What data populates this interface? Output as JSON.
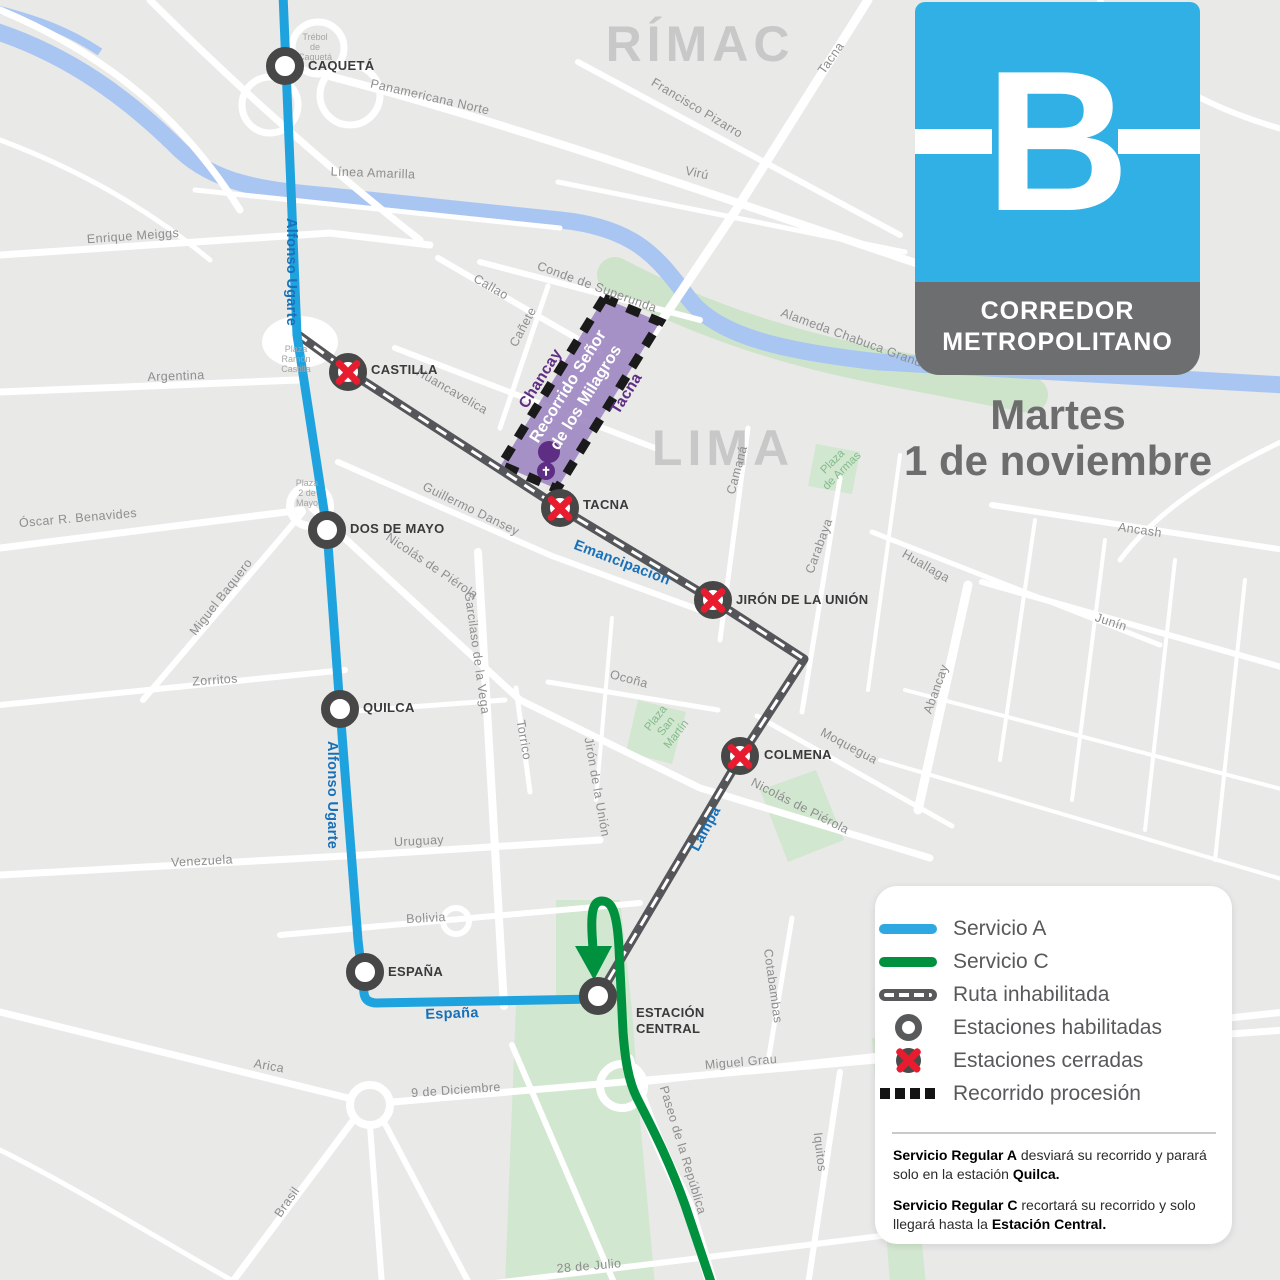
{
  "header": {
    "logo_letter": "B",
    "title_line1": "CORREDOR",
    "title_line2": "METROPOLITANO",
    "date_line1": "Martes",
    "date_line2": "1 de noviembre"
  },
  "legend": {
    "items": [
      {
        "icon": "line-blue",
        "label": "Servicio A"
      },
      {
        "icon": "line-green",
        "label": "Servicio C"
      },
      {
        "icon": "line-disabled",
        "label": "Ruta inhabilitada"
      },
      {
        "icon": "station-open",
        "label": "Estaciones habilitadas"
      },
      {
        "icon": "station-closed",
        "label": "Estaciones cerradas"
      },
      {
        "icon": "procession",
        "label": "Recorrido procesión"
      }
    ]
  },
  "notes": [
    {
      "segments": [
        {
          "text": "Servicio Regular A",
          "bold": true
        },
        {
          "text": " desviará su recorrido y parará solo en la estación ",
          "bold": false
        },
        {
          "text": "Quilca.",
          "bold": true
        }
      ]
    },
    {
      "segments": [
        {
          "text": "Servicio Regular C",
          "bold": true
        },
        {
          "text": " recortará su recorrido y solo llegará hasta la ",
          "bold": false
        },
        {
          "text": "Estación Central.",
          "bold": true
        }
      ]
    }
  ],
  "colors": {
    "servicio_a_blue": "#1FA3DF",
    "servicio_c_green": "#00913F",
    "ruta_inhabilitada_gray": "#54565A",
    "procession_purple": "#9D87C1",
    "purple_dark": "#5E2D84",
    "closed_red": "#E81C2E",
    "logo_blue": "#30B0E5",
    "logo_gray": "#6D6E70"
  },
  "map": {
    "procession_label": "Recorrido Señor\nde los Milagros",
    "church_glyph": "✝",
    "labels": [
      {
        "t": "RÍMAC",
        "x": 700,
        "y": 44,
        "r": 0,
        "s": "district"
      },
      {
        "t": "LIMA",
        "x": 723,
        "y": 448,
        "r": 0,
        "s": "district"
      },
      {
        "t": "Trébol\nde\nCaquetá",
        "x": 315,
        "y": 47,
        "r": 0,
        "s": "tiny"
      },
      {
        "t": "Panamericana Norte",
        "x": 430,
        "y": 97,
        "r": 13,
        "s": "st"
      },
      {
        "t": "Línea Amarilla",
        "x": 373,
        "y": 173,
        "r": 2,
        "s": "st"
      },
      {
        "t": "Enrique Meiggs",
        "x": 133,
        "y": 236,
        "r": -4,
        "s": "st"
      },
      {
        "t": "Alfonso Ugarte",
        "x": 291,
        "y": 272,
        "r": 90,
        "s": "blue"
      },
      {
        "t": "Alfonso Ugarte",
        "x": 332,
        "y": 795,
        "r": 90,
        "s": "blue"
      },
      {
        "t": "Argentina",
        "x": 176,
        "y": 376,
        "r": -2,
        "s": "st"
      },
      {
        "t": "Óscar R. Benavides",
        "x": 78,
        "y": 518,
        "r": -5,
        "s": "st"
      },
      {
        "t": "Miguel Baquero",
        "x": 221,
        "y": 597,
        "r": -52,
        "s": "st"
      },
      {
        "t": "Zorritos",
        "x": 215,
        "y": 680,
        "r": -4,
        "s": "st"
      },
      {
        "t": "Venezuela",
        "x": 202,
        "y": 861,
        "r": -3,
        "s": "st"
      },
      {
        "t": "Uruguay",
        "x": 419,
        "y": 841,
        "r": -3,
        "s": "st"
      },
      {
        "t": "Bolivia",
        "x": 426,
        "y": 918,
        "r": -3,
        "s": "st"
      },
      {
        "t": "España",
        "x": 452,
        "y": 1014,
        "r": -2,
        "s": "blue"
      },
      {
        "t": "Arica",
        "x": 269,
        "y": 1066,
        "r": 10,
        "s": "st"
      },
      {
        "t": "Brasil",
        "x": 287,
        "y": 1202,
        "r": -55,
        "s": "st"
      },
      {
        "t": "9 de Diciembre",
        "x": 456,
        "y": 1090,
        "r": -4,
        "s": "st"
      },
      {
        "t": "28 de Julio",
        "x": 589,
        "y": 1266,
        "r": -5,
        "s": "st"
      },
      {
        "t": "Miguel Grau",
        "x": 741,
        "y": 1062,
        "r": -5,
        "s": "st"
      },
      {
        "t": "Iquitos",
        "x": 820,
        "y": 1152,
        "r": 83,
        "s": "st"
      },
      {
        "t": "Cotabambas",
        "x": 773,
        "y": 986,
        "r": 82,
        "s": "st"
      },
      {
        "t": "Paseo de la República",
        "x": 683,
        "y": 1150,
        "r": 73,
        "s": "st"
      },
      {
        "t": "Lampa",
        "x": 706,
        "y": 829,
        "r": -62,
        "s": "blue"
      },
      {
        "t": "Nicolás de Piérola",
        "x": 800,
        "y": 806,
        "r": 27,
        "s": "st"
      },
      {
        "t": "Moquegua",
        "x": 849,
        "y": 746,
        "r": 28,
        "s": "st"
      },
      {
        "t": "Emancipación",
        "x": 622,
        "y": 563,
        "r": 21,
        "s": "blue"
      },
      {
        "t": "Ocoña",
        "x": 629,
        "y": 679,
        "r": 15,
        "s": "st"
      },
      {
        "t": "Jirón de la Unión",
        "x": 597,
        "y": 787,
        "r": 80,
        "s": "st"
      },
      {
        "t": "Torrico",
        "x": 524,
        "y": 740,
        "r": 80,
        "s": "st"
      },
      {
        "t": "Garcilaso de la Vega",
        "x": 477,
        "y": 653,
        "r": 82,
        "s": "st"
      },
      {
        "t": "Nicolás de Piérola",
        "x": 432,
        "y": 566,
        "r": 34,
        "s": "st"
      },
      {
        "t": "Guillermo Dansey",
        "x": 471,
        "y": 509,
        "r": 26,
        "s": "st"
      },
      {
        "t": "Huancavelica",
        "x": 452,
        "y": 391,
        "r": 30,
        "s": "st"
      },
      {
        "t": "Callao",
        "x": 491,
        "y": 287,
        "r": 30,
        "s": "st"
      },
      {
        "t": "Cañete",
        "x": 523,
        "y": 327,
        "r": -62,
        "s": "st"
      },
      {
        "t": "Chancay",
        "x": 541,
        "y": 379,
        "r": -58,
        "s": "purple"
      },
      {
        "t": "Tacna",
        "x": 627,
        "y": 394,
        "r": -58,
        "s": "purple"
      },
      {
        "t": "Conde de Superunda",
        "x": 597,
        "y": 287,
        "r": 20,
        "s": "st"
      },
      {
        "t": "Alameda Chabuca Granda",
        "x": 855,
        "y": 339,
        "r": 20,
        "s": "st"
      },
      {
        "t": "Francisco Pizarro",
        "x": 697,
        "y": 108,
        "r": 31,
        "s": "st"
      },
      {
        "t": "Virú",
        "x": 697,
        "y": 173,
        "r": 12,
        "s": "st"
      },
      {
        "t": "Tacna",
        "x": 831,
        "y": 58,
        "r": -55,
        "s": "st"
      },
      {
        "t": "Camaná",
        "x": 737,
        "y": 470,
        "r": -75,
        "s": "st"
      },
      {
        "t": "Carabaya",
        "x": 819,
        "y": 546,
        "r": -70,
        "s": "st"
      },
      {
        "t": "Huallaga",
        "x": 926,
        "y": 566,
        "r": 30,
        "s": "st"
      },
      {
        "t": "Ancash",
        "x": 1140,
        "y": 530,
        "r": 8,
        "s": "st"
      },
      {
        "t": "Junín",
        "x": 1111,
        "y": 622,
        "r": 18,
        "s": "st"
      },
      {
        "t": "Abancay",
        "x": 936,
        "y": 689,
        "r": -70,
        "s": "st"
      },
      {
        "t": "Plaza\nSan\nMartín",
        "x": 667,
        "y": 727,
        "r": -52,
        "s": "park"
      },
      {
        "t": "Plaza\nde Armas",
        "x": 838,
        "y": 467,
        "r": -45,
        "s": "park"
      },
      {
        "t": "Plaza\n2 de\nMayo",
        "x": 307,
        "y": 493,
        "r": 0,
        "s": "tiny"
      },
      {
        "t": "Plaza\nRamón\nCastilla",
        "x": 296,
        "y": 359,
        "r": 0,
        "s": "tiny"
      }
    ],
    "stations": [
      {
        "name": "CAQUETÁ",
        "x": 285,
        "y": 66,
        "closed": false,
        "lx": 308,
        "ly": 66
      },
      {
        "name": "CASTILLA",
        "x": 348,
        "y": 372,
        "closed": true,
        "lx": 371,
        "ly": 370
      },
      {
        "name": "DOS DE MAYO",
        "x": 327,
        "y": 530,
        "closed": false,
        "lx": 350,
        "ly": 529
      },
      {
        "name": "TACNA",
        "x": 560,
        "y": 508,
        "closed": true,
        "lx": 583,
        "ly": 505
      },
      {
        "name": "JIRÓN DE LA UNIÓN",
        "x": 713,
        "y": 600,
        "closed": true,
        "lx": 736,
        "ly": 600
      },
      {
        "name": "QUILCA",
        "x": 340,
        "y": 709,
        "closed": false,
        "lx": 363,
        "ly": 708
      },
      {
        "name": "COLMENA",
        "x": 740,
        "y": 756,
        "closed": true,
        "lx": 764,
        "ly": 755
      },
      {
        "name": "ESPAÑA",
        "x": 365,
        "y": 972,
        "closed": false,
        "lx": 388,
        "ly": 972
      },
      {
        "name": "ESTACIÓN\nCENTRAL",
        "x": 598,
        "y": 996,
        "closed": false,
        "lx": 636,
        "ly": 1021
      }
    ]
  }
}
